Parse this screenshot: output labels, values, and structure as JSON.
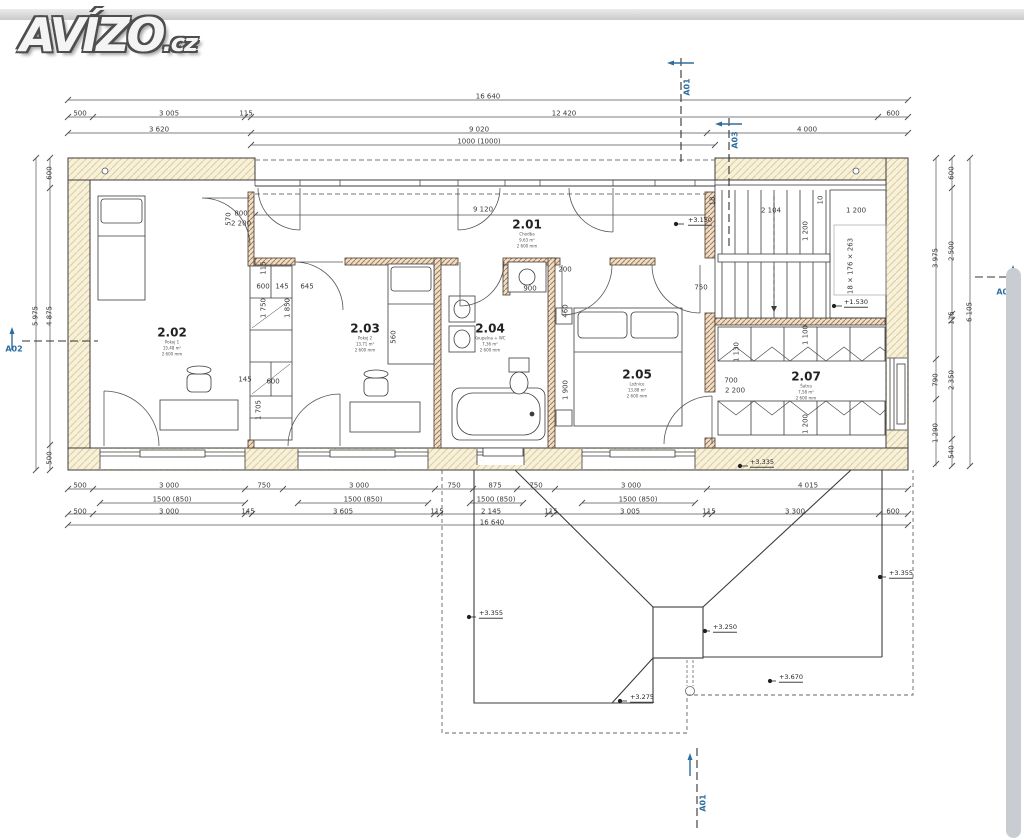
{
  "site": {
    "logo_main": "AVÍZO",
    "logo_suffix": ".cz"
  },
  "plan": {
    "dims_top": {
      "total": "16 640",
      "r2": [
        "500",
        "3 005",
        "115",
        "12 420",
        "600"
      ],
      "r3": [
        "3 620",
        "9 020",
        "4 000"
      ],
      "r4": "1000 (1000)"
    },
    "dims_bottom": {
      "r1": [
        "500",
        "3 000",
        "750",
        "3 000",
        "750",
        "875",
        "750",
        "3 000",
        "4 015"
      ],
      "r2": [
        "1500 (850)",
        "1500 (850)",
        "1500 (850)",
        "1500 (850)"
      ],
      "r3": [
        "500",
        "3 000",
        "145",
        "3 605",
        "115",
        "2 145",
        "115",
        "3 005",
        "115",
        "3 300",
        "600"
      ],
      "total": "16 640"
    },
    "dims_left": [
      "600",
      "4 875",
      "5 975",
      "500"
    ],
    "dims_right": [
      "3 975",
      "790",
      "1 290",
      "600",
      "2 500",
      "115",
      "2 350",
      "540",
      "6 105"
    ],
    "dims_interior": [
      "570",
      "800",
      "2 200",
      "9 120",
      "115",
      "600",
      "145",
      "645",
      "1 750",
      "1 850",
      "145",
      "600",
      "1 705",
      "560",
      "900",
      "200",
      "460",
      "1 900",
      "750",
      "700",
      "2 200",
      "1 130",
      "2 104",
      "1 200",
      "1 200",
      "1 100",
      "1 200",
      "18 × 176 × 263",
      "18",
      "10"
    ],
    "elevations": [
      "+3.150",
      "+1.530",
      "+3.335",
      "+3.355",
      "+3.250",
      "+3.275",
      "+3.670",
      "+3.355"
    ],
    "rooms": [
      {
        "id": "2.01",
        "l1": "Chodba",
        "l2": "9,63 m²",
        "l3": "2 600 mm"
      },
      {
        "id": "2.02",
        "l1": "Pokoj 1",
        "l2": "15,48 m²",
        "l3": "2 600 mm"
      },
      {
        "id": "2.03",
        "l1": "Pokoj 2",
        "l2": "13,71 m²",
        "l3": "2 600 mm"
      },
      {
        "id": "2.04",
        "l1": "Koupelna + WC",
        "l2": "7,36 m²",
        "l3": "2 600 mm"
      },
      {
        "id": "2.05",
        "l1": "Ložnice",
        "l2": "13,88 m²",
        "l3": "2 600 mm"
      },
      {
        "id": "2.07",
        "l1": "Šatna",
        "l2": "7,58 m²",
        "l3": "2 600 mm"
      }
    ],
    "sections": {
      "a01": "A01",
      "a02": "A02",
      "a03": "A03"
    }
  }
}
